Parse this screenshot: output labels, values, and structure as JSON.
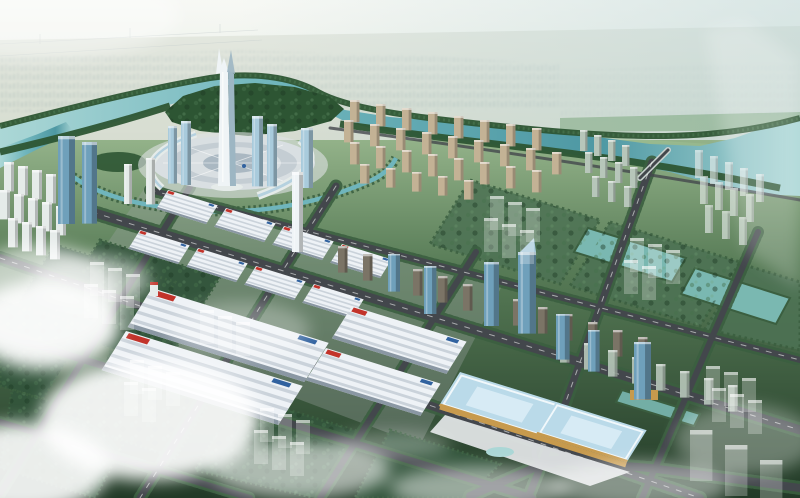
{
  "scene": {
    "setting": "aerial bird's-eye architectural rendering of a riverfront city masterplan",
    "time_of_day": "hazy daylight",
    "elements": [
      "hazy horizon",
      "distant low-rise city",
      "power lines",
      "winding turquoise river",
      "tree-lined riverbanks",
      "forested peninsula",
      "landmark supertall tower with forked crown",
      "circular central plaza",
      "curved exhibition halls",
      "twin blue glass towers",
      "white residential slab rows",
      "beige riverside apartment grid",
      "trade-market hall district with striped white roofs",
      "boulevard of glass office towers",
      "rows of apartment slabs",
      "white exhibition complex",
      "blue-glass convention center with forecourt and fountain",
      "river bridge",
      "cloverleaf interchange",
      "tree-lined road grid",
      "green superblocks with translucent future buildings",
      "wetland ponds",
      "low clouds and sun glare"
    ]
  },
  "colors": {
    "sky_top": "#eef1e8",
    "sky_mid": "#d8e2d8",
    "horizon_haze": "#e7eee7",
    "sky_right_tint": "#b7d2d4",
    "distant_land": "#c8d1c0",
    "distant_city": "#a7b7ac",
    "field_light": "#9cc094",
    "ground_top": "#93b289",
    "ground_mid": "#587c57",
    "ground_deep": "#223a27",
    "river_light": "#abd7d6",
    "river_mid": "#6fb5bc",
    "river_deep": "#4e98a3",
    "wetland": "#7ab8b1",
    "bank_trees": "#2d5533",
    "foliage_mid": "#46724c",
    "foliage_light": "#74a176",
    "green_block": "#33553c",
    "green_block_lt": "#4d7254",
    "hedge": "#3b5f40",
    "road": "#43474c",
    "road_line": "#ffffff",
    "bridge_deck": "#c9d2cf",
    "plaza_outer": "#d9dfe2",
    "plaza_ring": "#c4cdd3",
    "plaza_core": "#aab8c2",
    "plaza_ground": "#dfe3e4",
    "landmark": "#eff4f6",
    "landmark_shade": "#9db6c3",
    "glass_light": "#a9cbdc",
    "glass_mid": "#6fa0bb",
    "glass_dark": "#47738f",
    "white_bldg": "#e5ebe9",
    "beige": "#c3b295",
    "slab": "#7b7466",
    "pale_slab": "#b7c6ba",
    "hall_roof": "#eef2f6",
    "hall_stripe": "#c3cdd5",
    "hall_side": "#8a97a3",
    "hall_red": "#c2332a",
    "hall_blue": "#31629f",
    "hall_orange": "#d28f41",
    "conv_roof": "#badae9",
    "conv_roof_lt": "#dcedf7",
    "conv_wall": "#c79a4d",
    "cloud": "#ffffff",
    "pylon": "#93a2a2",
    "market_ground": "#9aa3a0",
    "boat": "#e8eef0"
  }
}
